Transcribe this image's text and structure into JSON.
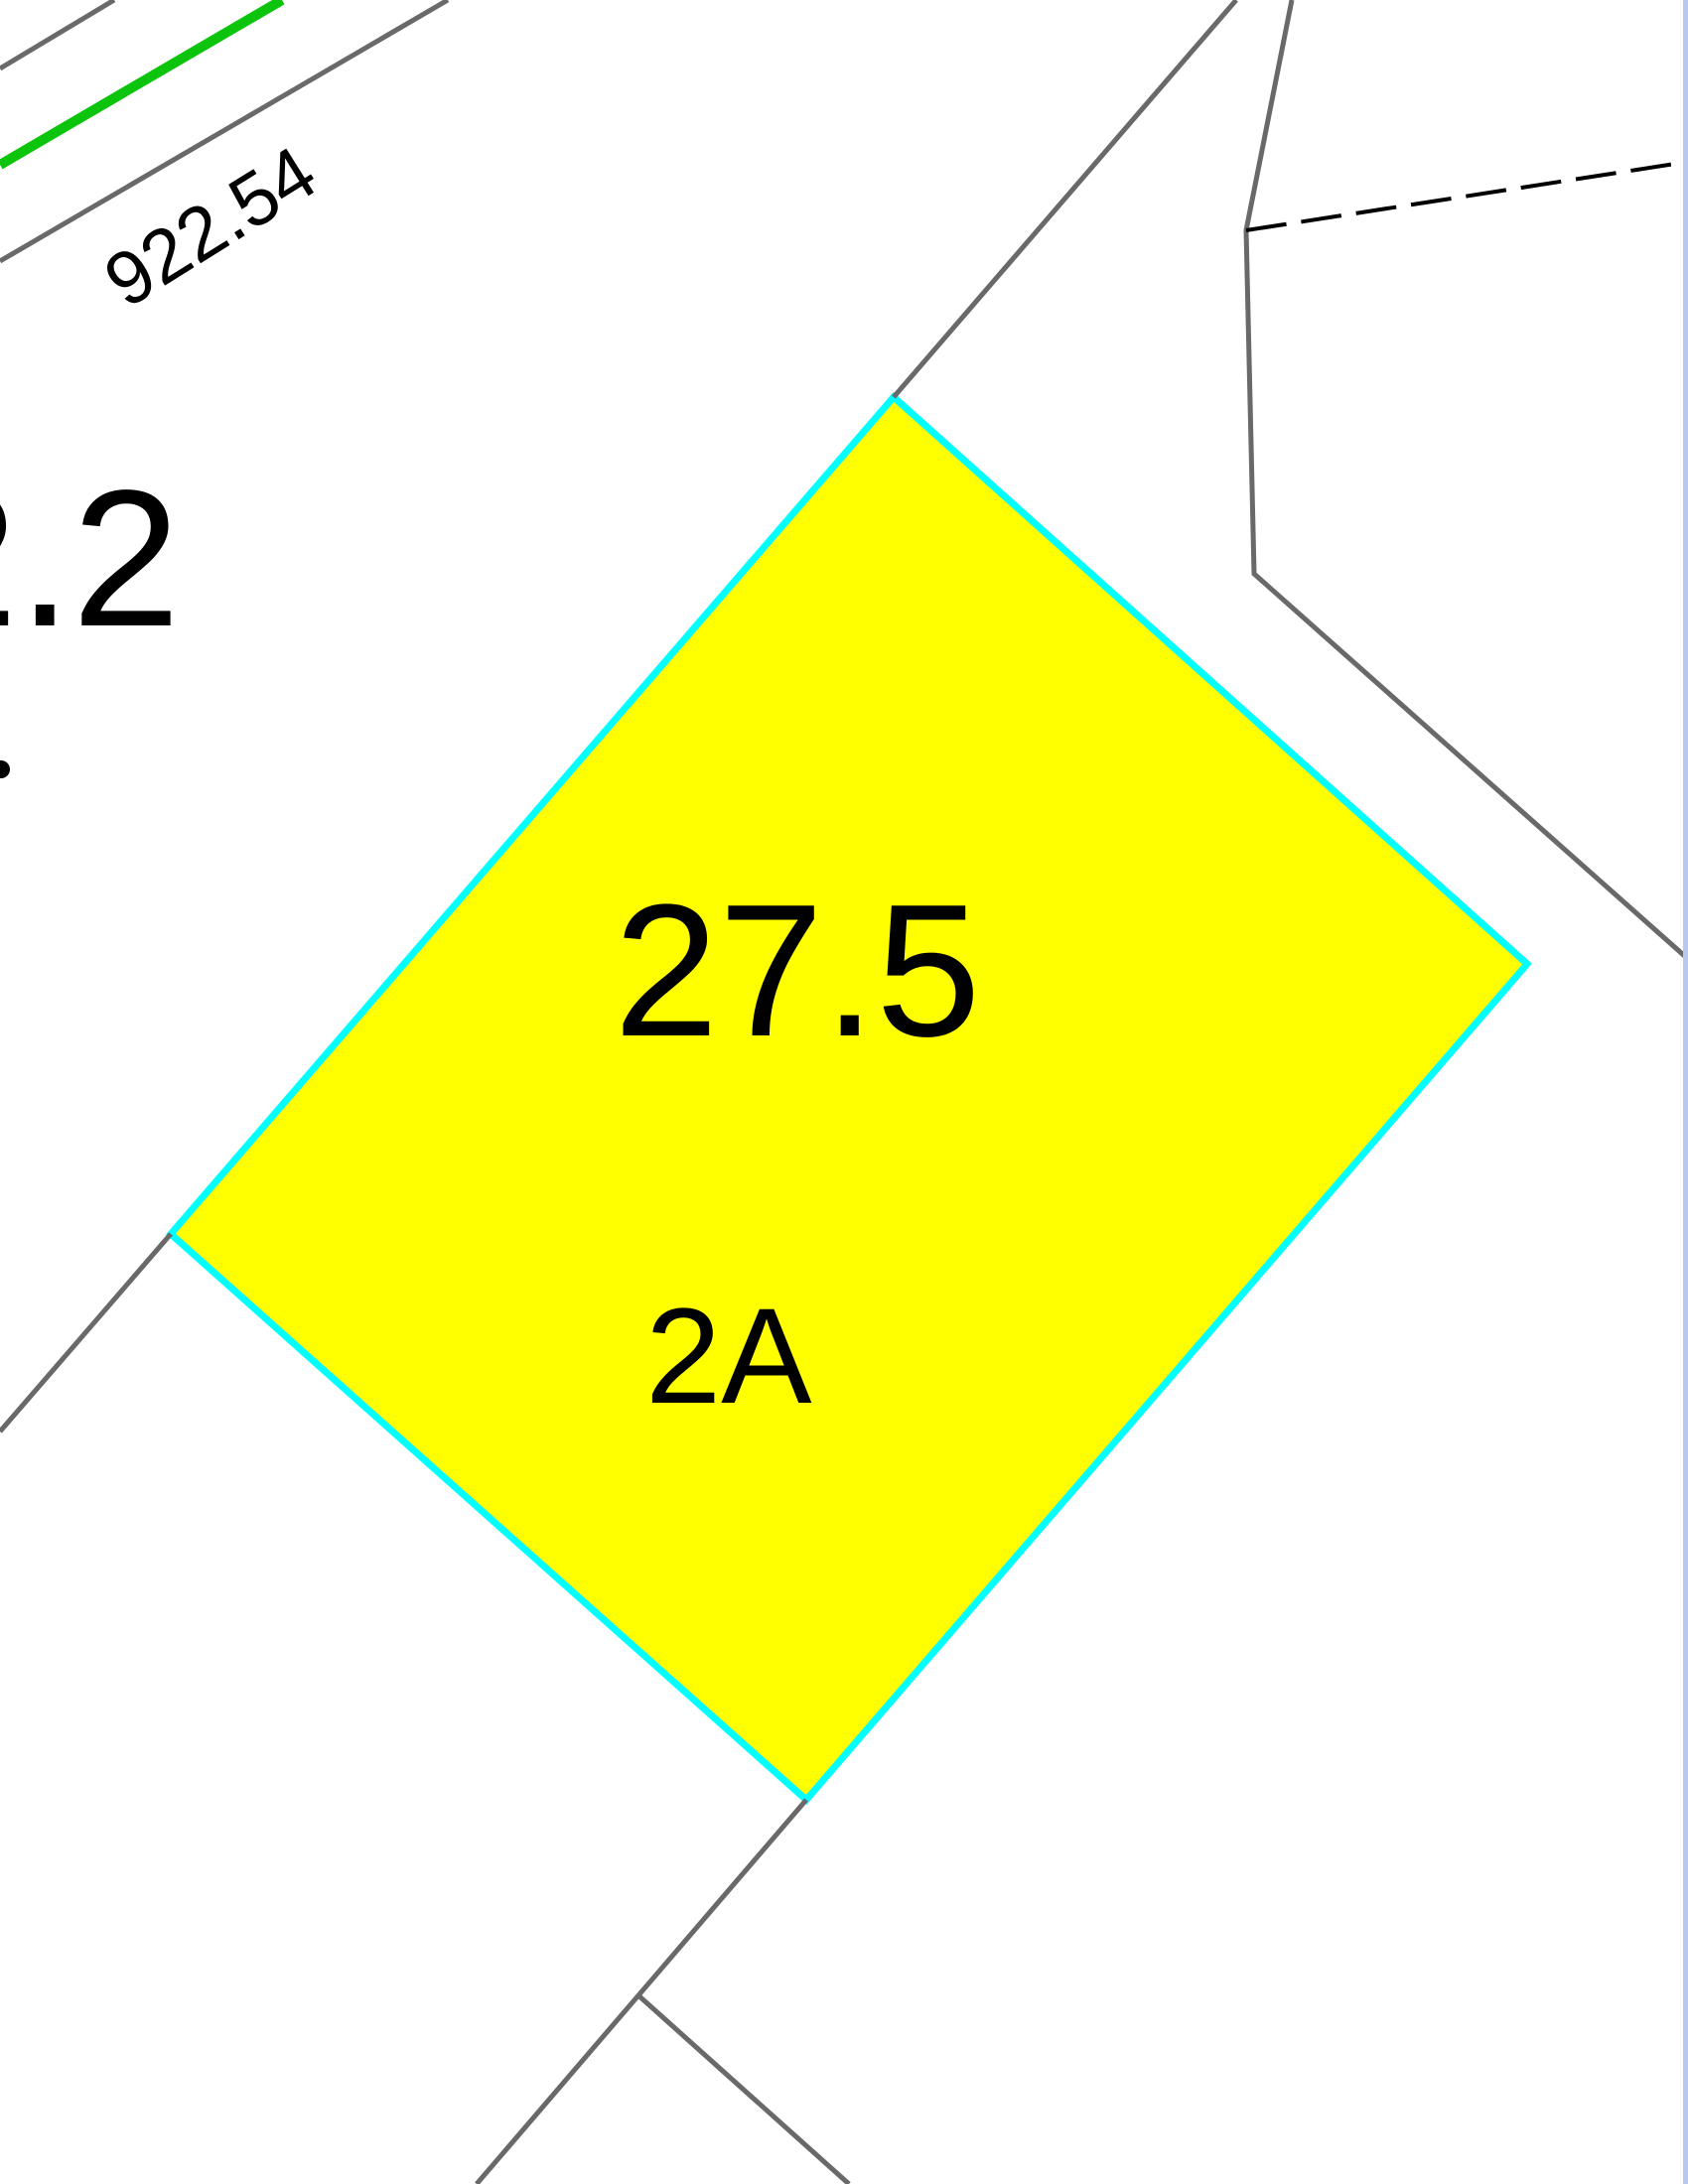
{
  "map_view": {
    "highlighted_parcel": {
      "area_label": "27.5",
      "lot_label": "2A",
      "fill_color": "#FFFF00",
      "outline_color": "#00FFFF"
    },
    "labels": {
      "boundary_distance": "922.54",
      "adjacent_parcel_partial": "2.2"
    },
    "colors": {
      "parcel_boundary_gray": "#696969",
      "highlight_line_green": "#0BC40B",
      "dashed_boundary_black": "#000000",
      "right_window_edge_blue": "#B8C9F0",
      "background": "#FFFFFF",
      "label_text": "#000000"
    }
  }
}
